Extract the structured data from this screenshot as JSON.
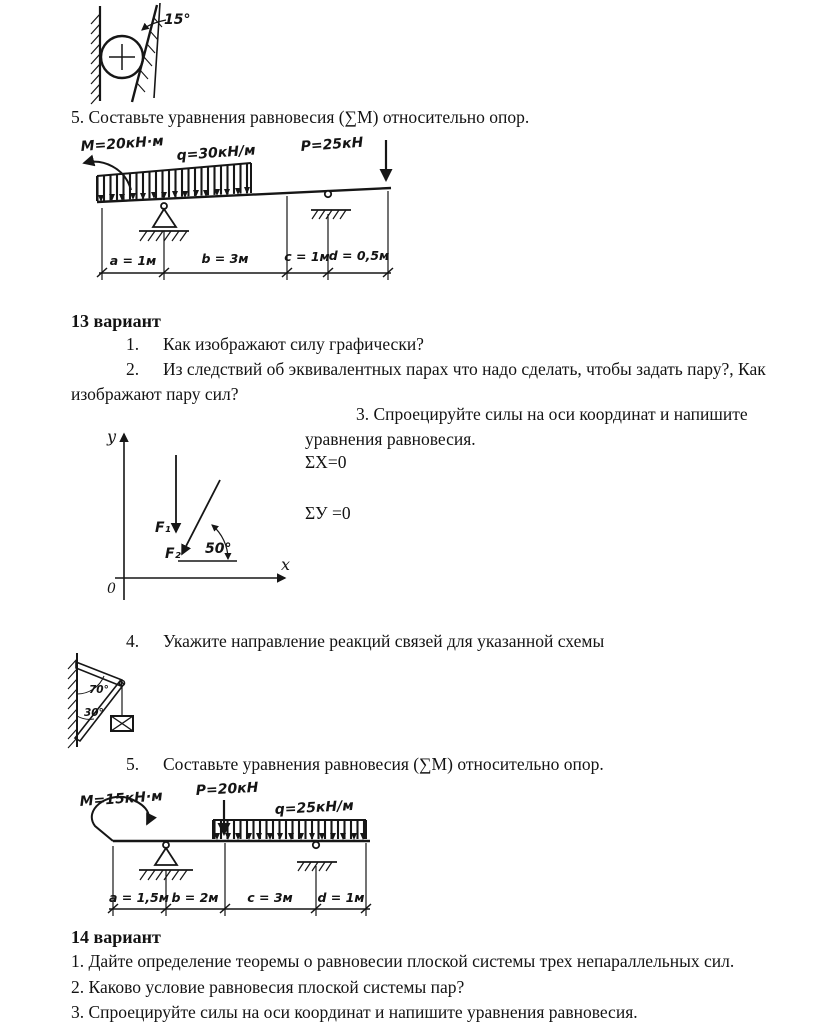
{
  "doc": {
    "q5_top": "5. Составьте уравнения равновесия (∑М) относительно опор.",
    "variant13": {
      "title": "13 вариант",
      "q1_num": "1.",
      "q1": "Как изображают силу графически?",
      "q2_num": "2.",
      "q2_line1": "Из следствий об эквивалентных парах что надо сделать, чтобы задать пару?, Как",
      "q2_line2": "изображают пару сил?",
      "q3_line1": "3. Спроецируйте силы на оси координат и напишите",
      "q3_line2": "уравнения равновесия.",
      "eq_x": "ΣХ=0",
      "eq_y": "ΣУ =0",
      "q4_num": "4.",
      "q4": "Укажите направление реакций связей для указанной схемы",
      "q5_num": "5.",
      "q5": "Составьте уравнения равновесия (∑М) относительно опор."
    },
    "variant14": {
      "title": "14 вариант",
      "q1": "1. Дайте определение теоремы о равновесии плоской системы трех непараллельных сил.",
      "q2": "2. Каково условие равновесия плоской системы пар?",
      "q3": "3. Спроецируйте силы на оси координат и напишите уравнения равновесия."
    }
  },
  "figures": {
    "cylinder": {
      "angle": "15°"
    },
    "beam1": {
      "moment": "М=20кН·м",
      "load": "q=30кН/м",
      "force": "Р=25кН",
      "dim_a": "a = 1м",
      "dim_b": "b = 3м",
      "dim_c": "c = 1м",
      "dim_d": "d = 0,5м"
    },
    "axes": {
      "y": "y",
      "x": "x",
      "origin": "0",
      "f1": "F₁",
      "f2": "F₂",
      "angle": "50°"
    },
    "truss": {
      "angle_top": "70°",
      "angle_bottom": "30°"
    },
    "beam2": {
      "moment": "М=15кН·м",
      "force": "Р=20кН",
      "load": "q=25кН/м",
      "dim_a": "a = 1,5м",
      "dim_b": "b = 2м",
      "dim_c": "c = 3м",
      "dim_d": "d = 1м"
    }
  }
}
